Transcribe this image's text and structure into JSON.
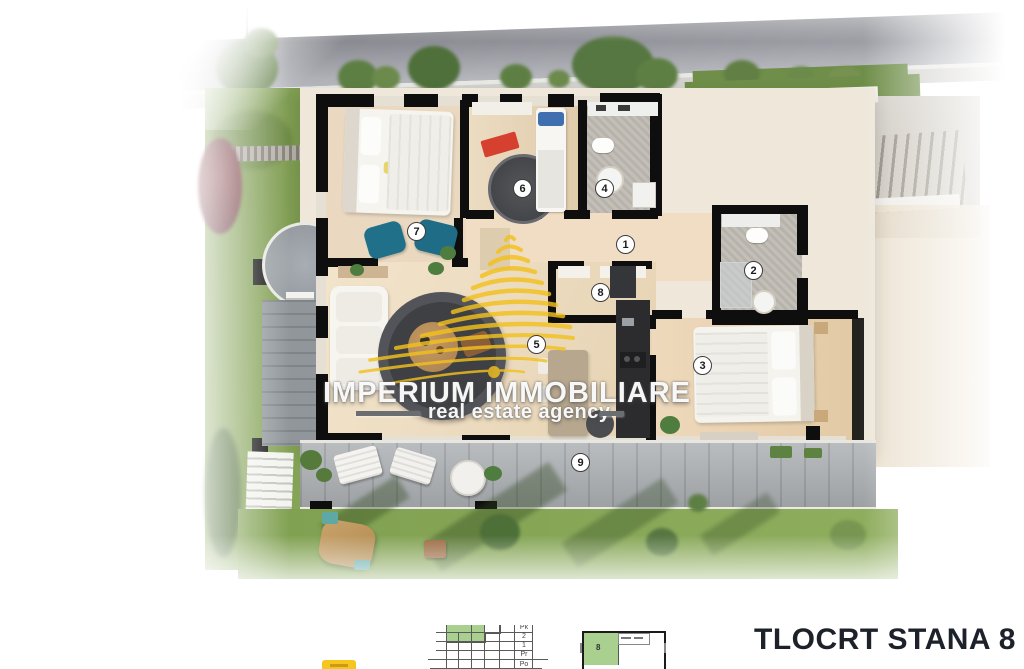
{
  "watermark": {
    "brand": "IMPERIUM IMMOBILIARE",
    "tagline": "real estate agency"
  },
  "title": "TLOCRT STANA 8",
  "markers": [
    {
      "num": "1"
    },
    {
      "num": "2"
    },
    {
      "num": "3"
    },
    {
      "num": "4"
    },
    {
      "num": "5"
    },
    {
      "num": "6"
    },
    {
      "num": "7"
    },
    {
      "num": "8"
    },
    {
      "num": "9"
    }
  ],
  "section_diagram": {
    "floors": [
      "Pk",
      "2",
      "1",
      "Pr",
      "Po"
    ]
  },
  "plate_diagram": {
    "unit": "8"
  },
  "colors": {
    "logo_gold": "#F2C11E",
    "highlight_green": "#A9D08E",
    "title_ink": "#1D2129",
    "wall_black": "#0E0E0E",
    "grass": "#7FA050",
    "teal_chair": "#20708A"
  }
}
